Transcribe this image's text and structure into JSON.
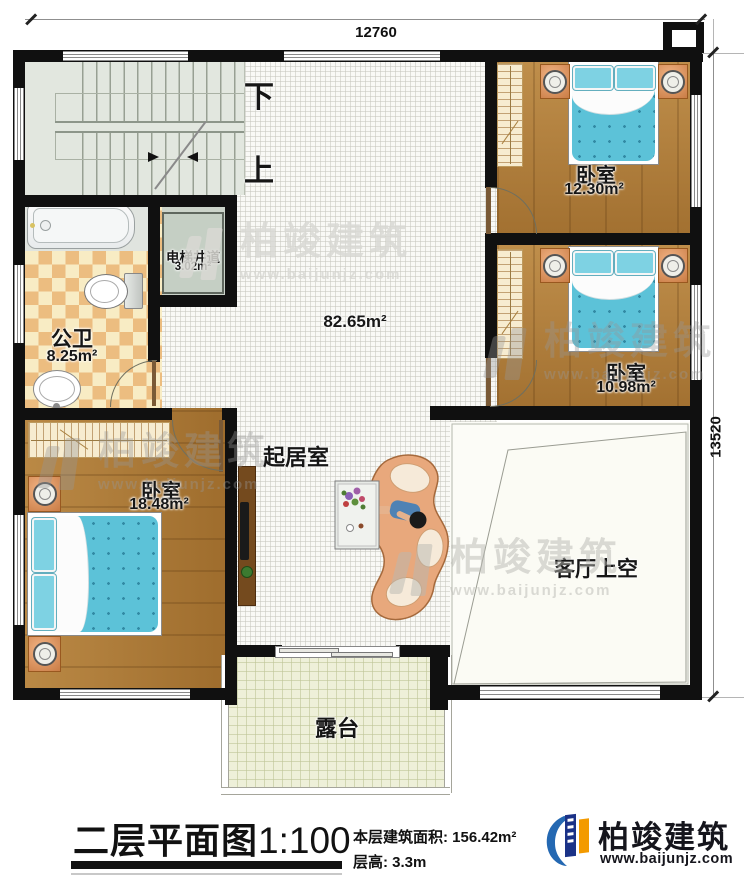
{
  "plan": {
    "dim_top": "12760",
    "dim_right": "13520",
    "stair_down": "下",
    "stair_up": "上"
  },
  "rooms": {
    "elevator": {
      "name": "电梯井道",
      "area": "3.02m²"
    },
    "bathroom": {
      "name": "公卫",
      "area": "8.25m²"
    },
    "bedroom_top": {
      "name": "卧室",
      "area": "12.30m²"
    },
    "bedroom_mid": {
      "name": "卧室",
      "area": "10.98m²"
    },
    "bedroom_left": {
      "name": "卧室",
      "area": "18.48m²"
    },
    "living": {
      "name": "起居室",
      "area": "82.65m²"
    },
    "void": {
      "name": "客厅上空"
    },
    "terrace": {
      "name": "露台"
    }
  },
  "footer": {
    "title": "二层平面图",
    "scale": "1:100",
    "area_label": "本层建筑面积: ",
    "area_value": "156.42m²",
    "floor_height_label": "层高: ",
    "floor_height_value": "3.3m"
  },
  "brand": {
    "name": "柏竣建筑",
    "website": "www.baijunjz.com"
  },
  "colors": {
    "wall": "#101010",
    "wood_floor": "#b17c36",
    "bed_blue": "#5cc2d8",
    "tile_tan": "#ecbd80",
    "brand_navy": "#1b3287",
    "brand_blue": "#2468b2",
    "brand_orange": "#f39a00"
  }
}
